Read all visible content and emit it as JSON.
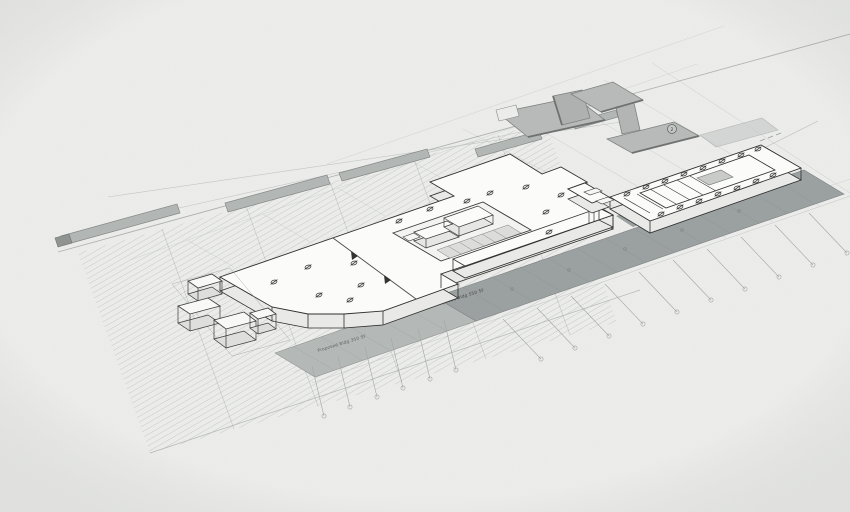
{
  "drawing": {
    "kind": "architectural axonometric site plan",
    "annotations": {
      "strip_label_left": "Proposed Bldg 350 SF",
      "strip_label_mid": "Proposed Bldg 550 SF",
      "roof_detail_marker": "2",
      "column_marker_glyph": "Ø"
    },
    "colors": {
      "paper": "#ecedeb",
      "slab_top": "#fbfbf9",
      "slab_side": "#e9e9e7",
      "outline": "#2f2f2f",
      "roof_fill": "#b7bab8",
      "roof_edge": "#6e7170",
      "sidewalk": "#9ba0a0",
      "planting_strip": "#b2b6b4",
      "hatch_line": "#bdc0bf",
      "faint_line": "#cfd2d1",
      "leader": "#a3a7a6"
    }
  }
}
